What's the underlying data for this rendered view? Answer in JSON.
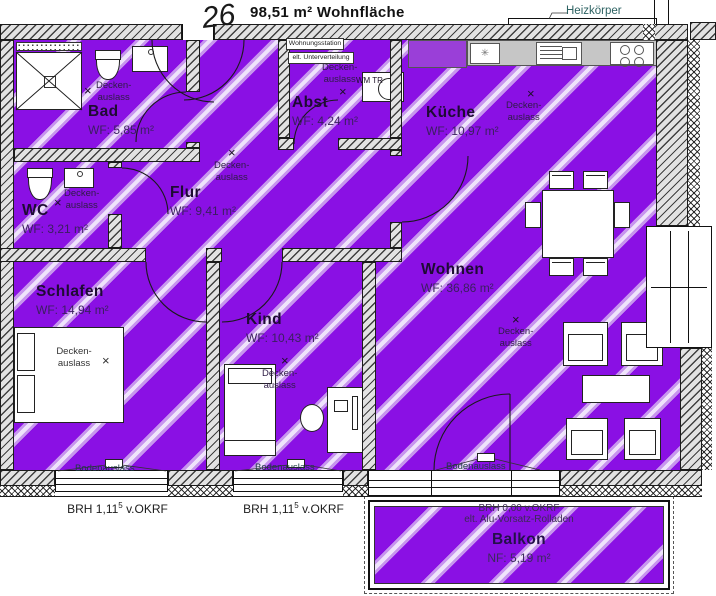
{
  "header": {
    "apartment_number": "26",
    "total_area": "98,51 m² Wohnfläche",
    "radiator": "Heizkörper"
  },
  "rooms": {
    "bad": {
      "name": "Bad",
      "area": "WF: 5,85 m²"
    },
    "wc": {
      "name": "WC",
      "area": "WF: 3,21 m²"
    },
    "flur": {
      "name": "Flur",
      "area": "WF: 9,41 m²"
    },
    "abst": {
      "name": "Abst",
      "area": "WF: 4,24 m²"
    },
    "kueche": {
      "name": "Küche",
      "area": "WF: 10,97 m²"
    },
    "wohnen": {
      "name": "Wohnen",
      "area": "WF: 36,86 m²"
    },
    "schlafen": {
      "name": "Schlafen",
      "area": "WF: 14,94 m²"
    },
    "kind": {
      "name": "Kind",
      "area": "WF: 10,43 m²"
    },
    "balkon": {
      "name": "Balkon",
      "area": "NF: 5,19 m²"
    }
  },
  "labels": {
    "ceiling_outlet_line1": "Decken-",
    "ceiling_outlet_line2": "auslass",
    "outlet_marker": "×",
    "floor_outlet": "Bodenauslass",
    "station_line1": "Wohnungsstation",
    "station_line2": "elt. Unterverteilung",
    "washer": "WM TR",
    "sink_star": "✳",
    "window_sill": {
      "pre": "BRH  1,11",
      "sup": "5",
      "post": " v.OKRF"
    },
    "balkon_brh_line1": "BRH  0,00 v.OKRF",
    "balkon_brh_line2": "elt. Alu-Vorsatz-Rolladen"
  },
  "colors": {
    "floor": "#8a10e4",
    "stripe": "#c795ee",
    "stripe_core": "#efe3fb",
    "wall_hatch": "#3f3f3f"
  }
}
